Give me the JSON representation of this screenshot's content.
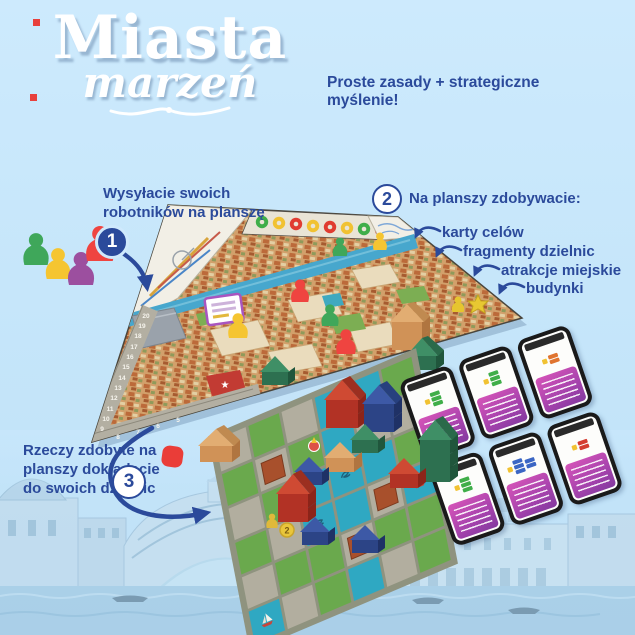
{
  "title": {
    "line1": "Miasta",
    "line2": "marzeń"
  },
  "tagline": "Proste zasady + strategiczne myślenie!",
  "steps": [
    {
      "number": "1",
      "label": "Wysyłacie swoich robotników na planszę"
    },
    {
      "number": "2",
      "label": "Na planszy zdobywacie:",
      "bullets": [
        "karty celów",
        "fragmenty dzielnic",
        "atrakcje miejskie",
        "budynki"
      ]
    },
    {
      "number": "3",
      "label": "Rzeczy zdobyte na planszy dokładacie do swoich dzielnic"
    }
  ],
  "board": {
    "score_track_numbers": [
      "20",
      "19",
      "18",
      "17",
      "16",
      "15",
      "14",
      "13",
      "12",
      "11",
      "10",
      "9",
      "8",
      "7",
      "6",
      "5"
    ],
    "coin_value": "2"
  },
  "colors": {
    "accent_navy": "#2b4a9b",
    "background_sky": "#c7e6fb",
    "meeple_red": "#ef4440",
    "meeple_yellow": "#f5c531",
    "meeple_green": "#3fa75a",
    "meeple_purple": "#9c4f9f",
    "card_purple": "#a94fb0"
  }
}
